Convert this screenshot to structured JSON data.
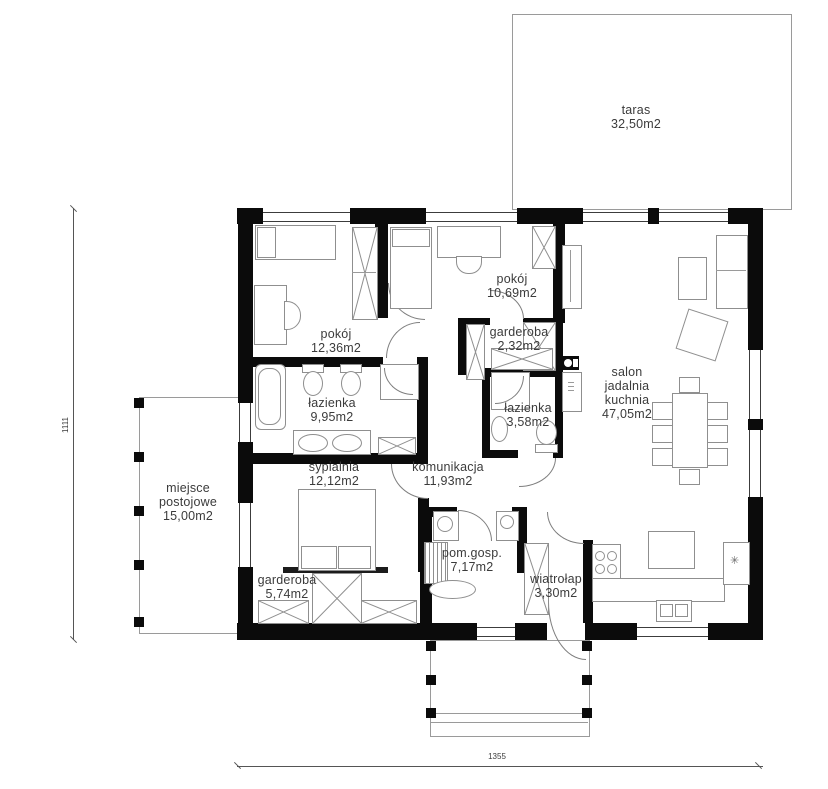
{
  "rooms": [
    {
      "key": "taras",
      "name": "taras",
      "area": "32,50m2"
    },
    {
      "key": "pokoj-1",
      "name": "pokój",
      "area": "12,36m2"
    },
    {
      "key": "pokoj-2",
      "name": "pokój",
      "area": "10,69m2"
    },
    {
      "key": "garderoba-1",
      "name": "garderoba",
      "area": "2,32m2"
    },
    {
      "key": "lazienka-1",
      "name": "łazienka",
      "area": "9,95m2"
    },
    {
      "key": "lazienka-2",
      "name": "łazienka",
      "area": "3,58m2"
    },
    {
      "key": "salon",
      "name": "salon jadalnia kuchnia",
      "area": "47,05m2"
    },
    {
      "key": "sypialnia",
      "name": "sypialnia",
      "area": "12,12m2"
    },
    {
      "key": "komunikacja",
      "name": "komunikacja",
      "area": "11,93m2"
    },
    {
      "key": "miejsce-postojowe",
      "name": "miejsce postojowe",
      "area": "15,00m2"
    },
    {
      "key": "pom-gosp",
      "name": "pom.gosp.",
      "area": "7,17m2"
    },
    {
      "key": "garderoba-2",
      "name": "garderoba",
      "area": "5,74m2"
    },
    {
      "key": "wiatrolap",
      "name": "wiatrołap",
      "area": "3,30m2"
    }
  ],
  "dimensions": {
    "bottom": "1355",
    "left": "1111"
  },
  "colors": {
    "wall": "#0b0b0b",
    "outline": "#8f8f8f",
    "text": "#3b3b3b",
    "background": "#ffffff"
  }
}
